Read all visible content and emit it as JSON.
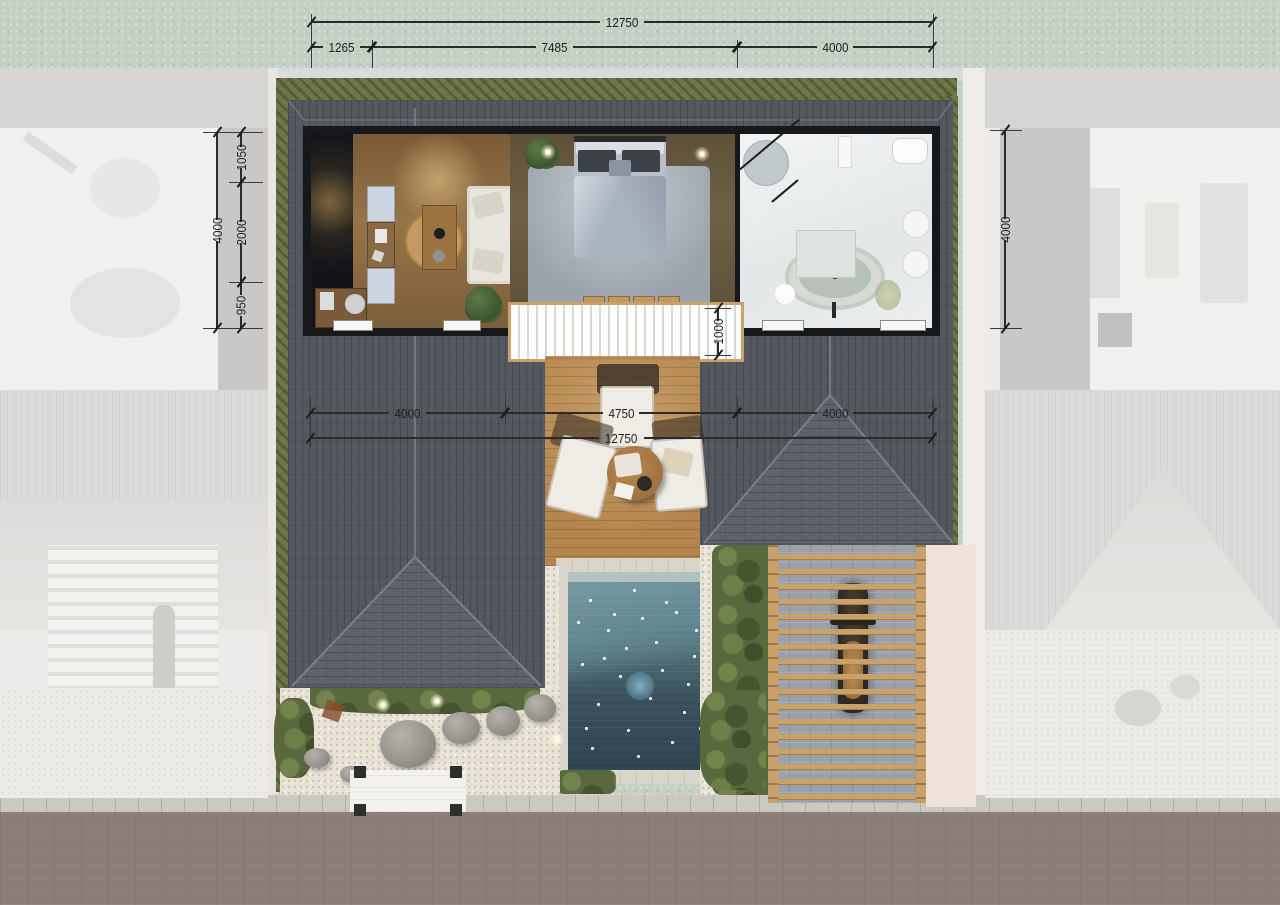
{
  "scene": {
    "kind": "villa-site-plan-top-view",
    "units": "mm"
  },
  "dimensions": {
    "top": {
      "total": "12750",
      "segments": [
        "1265",
        "7485",
        "4000"
      ]
    },
    "left": {
      "total": "4000",
      "segments": [
        "1050",
        "2000",
        "950"
      ]
    },
    "right": {
      "total": "4000"
    },
    "middle": {
      "total": "12750",
      "segments": [
        "4000",
        "4750",
        "4000"
      ]
    },
    "terrace_step": "1000"
  },
  "colors": {
    "background_grass": "#c4d0c3",
    "road": "#8b7d77",
    "curb": "#ccc9c1",
    "roof_dark": "#54585f",
    "roof_hip": "#5e626a",
    "hedge_green": "#6d7849",
    "deck_wood": "#b5854e",
    "pergola_wood": "#c9a26b",
    "pool_shallow": "#6d939b",
    "pool_deep": "#2e4451",
    "gravel": "#e8e3d5",
    "wall_black": "#17181c",
    "bathroom_floor": "#eceeee",
    "living_floor": "#97744a",
    "bedroom_floor": "#6f6146",
    "dimension_line": "#2b2b2b",
    "faded_neighbor": "#ecebe9"
  }
}
